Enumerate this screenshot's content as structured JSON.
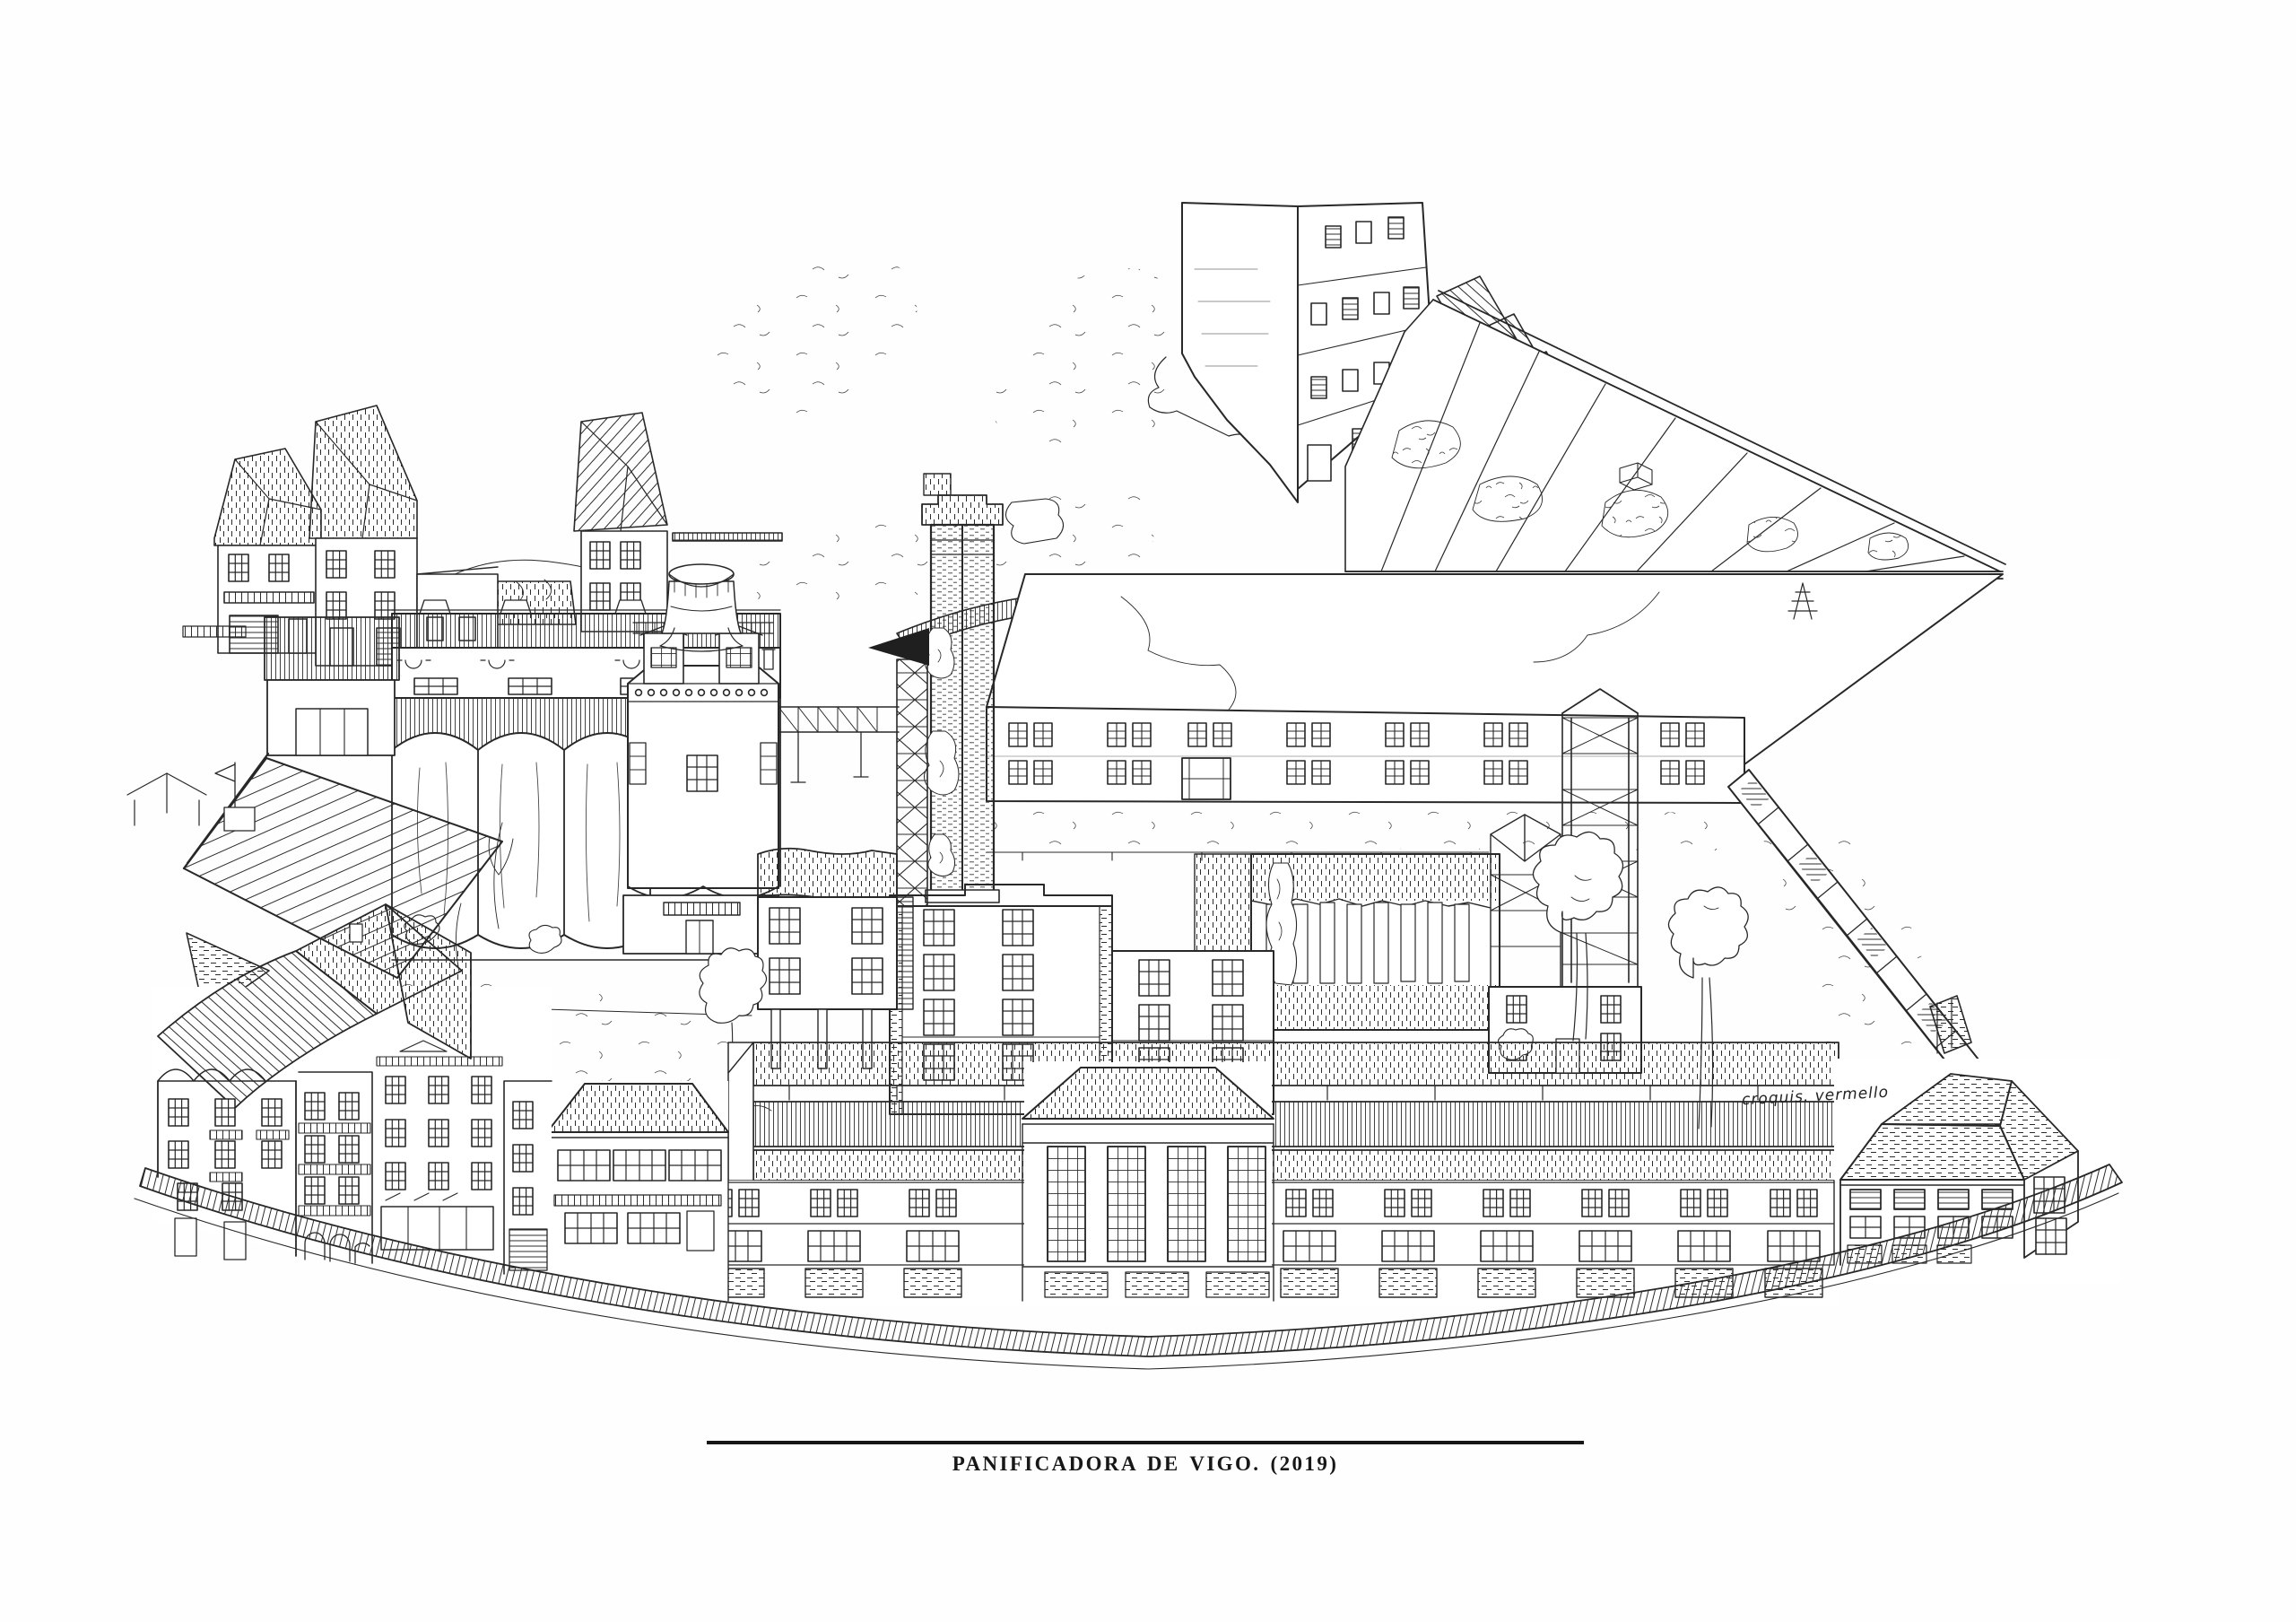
{
  "artwork": {
    "caption": "PANIFICADORA DE VIGO. (2019)",
    "signature": "croquis. vermello",
    "ink_color": "#262626",
    "paper_color": "#fefefe"
  }
}
